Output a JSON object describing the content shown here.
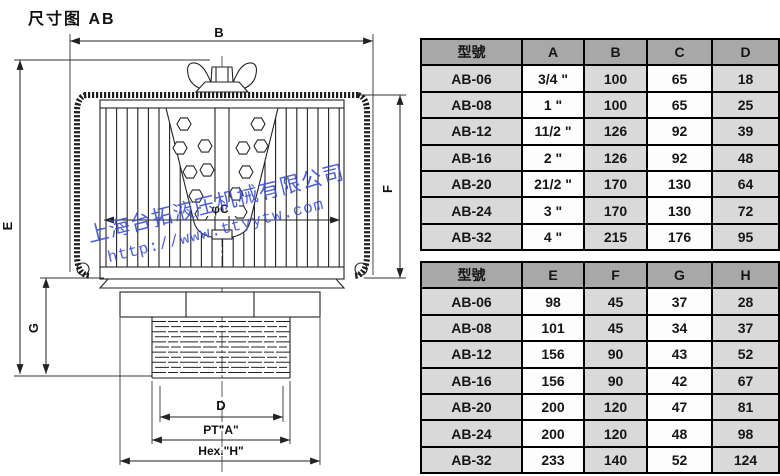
{
  "page": {
    "title": "尺寸图 AB"
  },
  "watermark": {
    "company": "上海台拓液压机械有限公司",
    "url": "http://www.ttyytw.com",
    "color": "#3b4fd2"
  },
  "diagram": {
    "labels": {
      "b": "B",
      "e": "E",
      "f": "F",
      "g": "G",
      "phi_c": "φC",
      "d": "D",
      "pt_a": "PT\"A\"",
      "hex_h": "Hex.\"H\""
    }
  },
  "colors": {
    "table_header_bg": "#a8a8a8",
    "table_shaded_cell_bg": "#d9d9d9",
    "table_plain_cell_bg": "#fdfdfd",
    "table_border": "#000000",
    "drawing_line": "#222222"
  },
  "tables": [
    {
      "headers": [
        "型號",
        "A",
        "B",
        "C",
        "D"
      ],
      "rows": [
        [
          "AB-06",
          "3/4 \"",
          "100",
          "65",
          "18"
        ],
        [
          "AB-08",
          "1 \"",
          "100",
          "65",
          "25"
        ],
        [
          "AB-12",
          "11/2 \"",
          "126",
          "92",
          "39"
        ],
        [
          "AB-16",
          "2 \"",
          "126",
          "92",
          "48"
        ],
        [
          "AB-20",
          "21/2 \"",
          "170",
          "130",
          "64"
        ],
        [
          "AB-24",
          "3 \"",
          "170",
          "130",
          "72"
        ],
        [
          "AB-32",
          "4 \"",
          "215",
          "176",
          "95"
        ]
      ]
    },
    {
      "headers": [
        "型號",
        "E",
        "F",
        "G",
        "H"
      ],
      "rows": [
        [
          "AB-06",
          "98",
          "45",
          "37",
          "28"
        ],
        [
          "AB-08",
          "101",
          "45",
          "34",
          "37"
        ],
        [
          "AB-12",
          "156",
          "90",
          "43",
          "52"
        ],
        [
          "AB-16",
          "156",
          "90",
          "42",
          "67"
        ],
        [
          "AB-20",
          "200",
          "120",
          "47",
          "81"
        ],
        [
          "AB-24",
          "200",
          "120",
          "48",
          "98"
        ],
        [
          "AB-32",
          "233",
          "140",
          "52",
          "124"
        ]
      ]
    }
  ]
}
